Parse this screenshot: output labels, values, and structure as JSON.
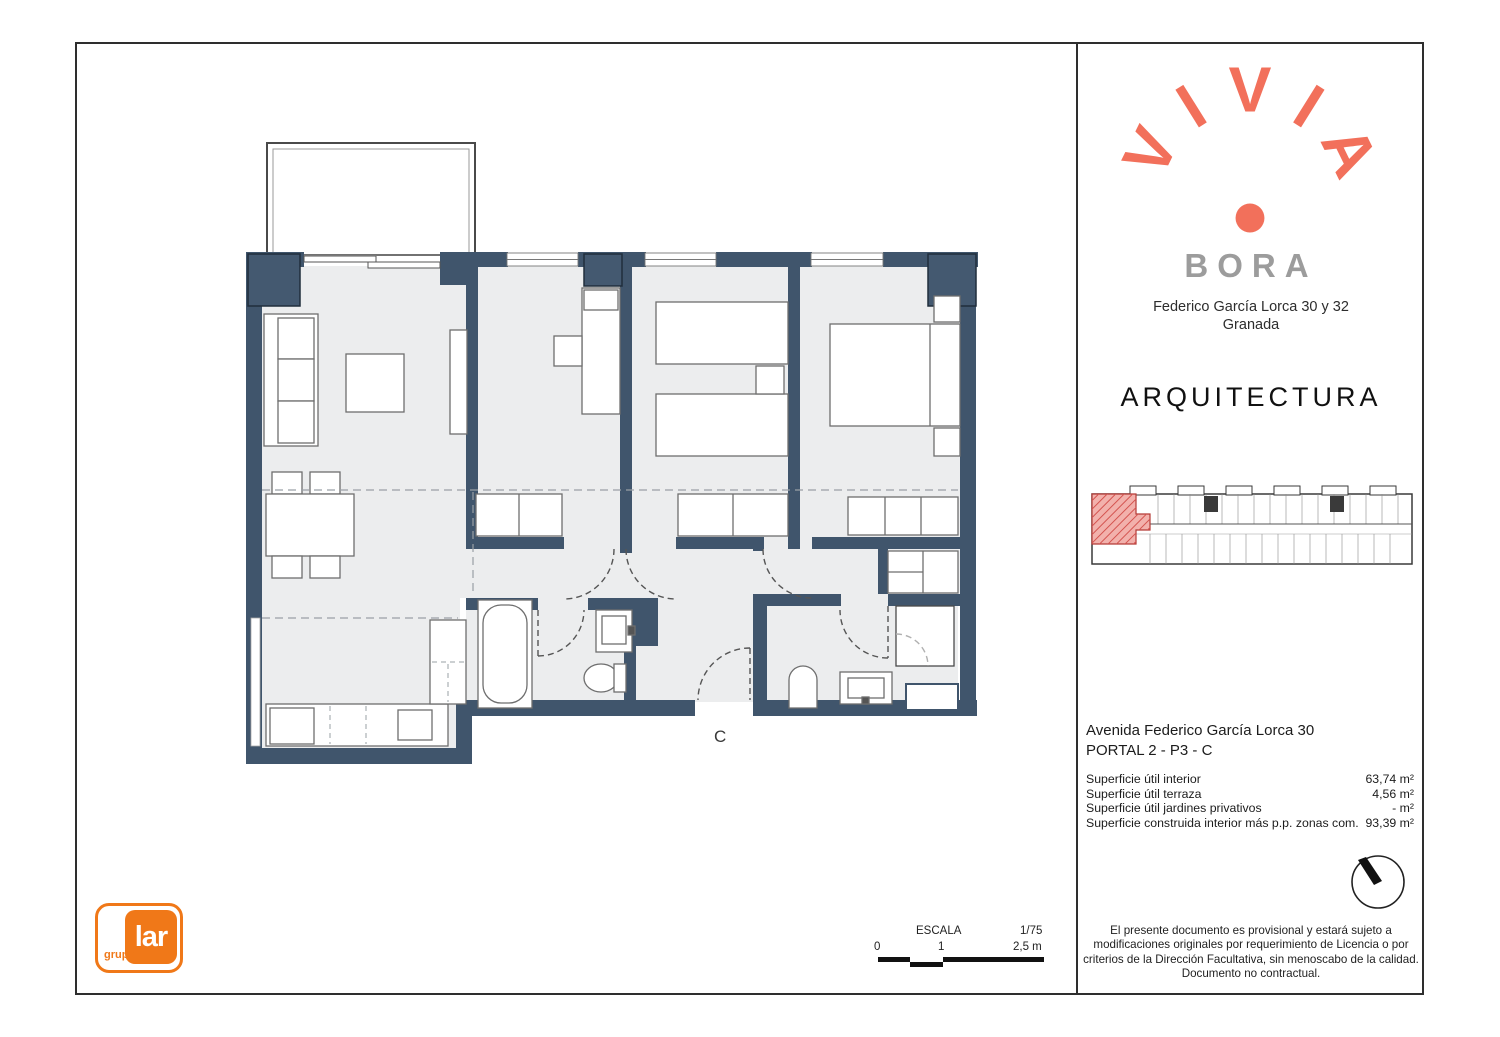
{
  "brand": {
    "logo_letters": [
      "V",
      "I",
      "V",
      "I",
      "A"
    ],
    "project": "BORA",
    "address_line1": "Federico García Lorca 30 y 32",
    "address_line2": "Granada",
    "discipline": "ARQUITECTURA"
  },
  "unit": {
    "street": "Avenida Federico García Lorca 30",
    "portal": "PORTAL 2 - P3 - C",
    "unit_label": "C",
    "areas": [
      {
        "label": "Superficie útil interior",
        "value": "63,74 m²"
      },
      {
        "label": "Superficie útil terraza",
        "value": "4,56 m²"
      },
      {
        "label": "Superficie útil jardines privativos",
        "value": "- m²"
      },
      {
        "label": "Superficie construida interior más p.p. zonas com.",
        "value": "93,39 m²"
      }
    ]
  },
  "scale_bar": {
    "title": "ESCALA",
    "ratio": "1/75",
    "tick0": "0",
    "tick1": "1",
    "tick2": "2,5 m"
  },
  "disclaimer": "El presente documento es provisional y estará sujeto a modificaciones originales por requerimiento de Licencia o por criterios de la Dirección Facultativa, sin menoscabo de la calidad. Documento no contractual.",
  "partner": {
    "group": "grupo",
    "name": "lar"
  },
  "colors": {
    "accent_coral": "#F2705B",
    "wall_navy": "#40556C",
    "bora_gray": "#9C9C9C",
    "lar_orange": "#F07818",
    "highlight_red": "#E0807C",
    "floor_gray": "#ECEDEE"
  }
}
